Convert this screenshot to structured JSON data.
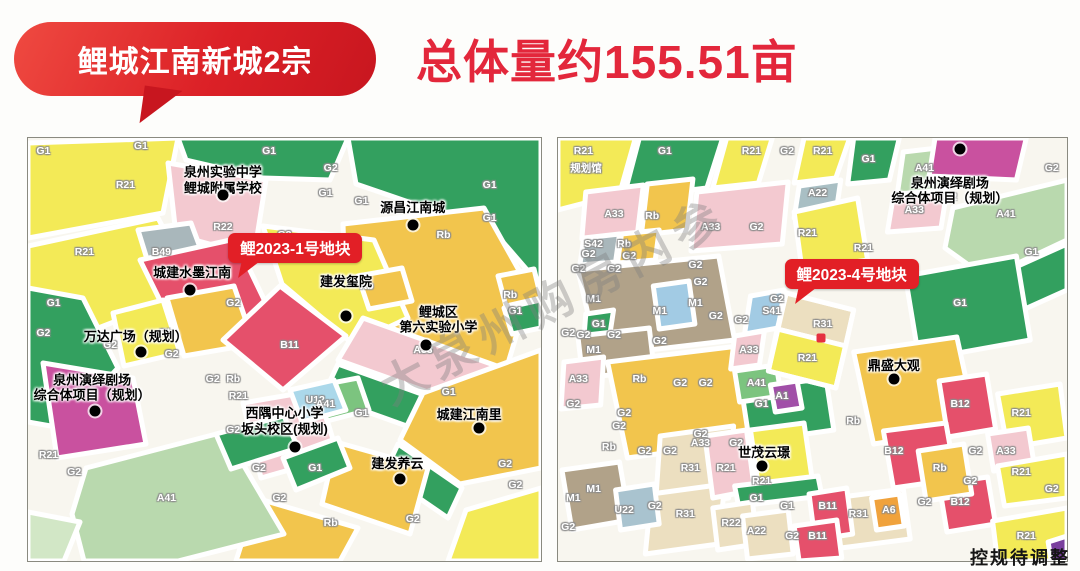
{
  "banner": {
    "label": "鲤城江南新城2宗"
  },
  "title": {
    "text": "总体量约155.51亩"
  },
  "watermark": {
    "text": "大泉州购房内参"
  },
  "footer": {
    "note": "控规待调整"
  },
  "maps": {
    "left": {
      "callout": {
        "text": "鲤2023-1号地块"
      },
      "featured_parcel": "B11",
      "codes": [
        {
          "t": "G1",
          "x": 3,
          "y": 3
        },
        {
          "t": "G1",
          "x": 22,
          "y": 2
        },
        {
          "t": "G1",
          "x": 47,
          "y": 3
        },
        {
          "t": "G2",
          "x": 59,
          "y": 7
        },
        {
          "t": "G1",
          "x": 58,
          "y": 13
        },
        {
          "t": "G1",
          "x": 65,
          "y": 15
        },
        {
          "t": "G1",
          "x": 90,
          "y": 11
        },
        {
          "t": "G1",
          "x": 90,
          "y": 19
        },
        {
          "t": "Rb",
          "x": 81,
          "y": 23
        },
        {
          "t": "R21",
          "x": 19,
          "y": 11
        },
        {
          "t": "R21",
          "x": 11,
          "y": 27
        },
        {
          "t": "B49",
          "x": 26,
          "y": 27
        },
        {
          "t": "R22",
          "x": 38,
          "y": 21
        },
        {
          "t": "G2",
          "x": 50,
          "y": 23
        },
        {
          "t": "G1",
          "x": 5,
          "y": 39
        },
        {
          "t": "G2",
          "x": 3,
          "y": 46
        },
        {
          "t": "G2",
          "x": 16,
          "y": 49
        },
        {
          "t": "Rb",
          "x": 27,
          "y": 46
        },
        {
          "t": "G2",
          "x": 28,
          "y": 51
        },
        {
          "t": "G2",
          "x": 36,
          "y": 57
        },
        {
          "t": "Rb",
          "x": 40,
          "y": 57
        },
        {
          "t": "B11",
          "x": 51,
          "y": 49
        },
        {
          "t": "U12",
          "x": 56,
          "y": 62
        },
        {
          "t": "Rb",
          "x": 66,
          "y": 35
        },
        {
          "t": "G2",
          "x": 40,
          "y": 39
        },
        {
          "t": "A33",
          "x": 77,
          "y": 50
        },
        {
          "t": "Rb",
          "x": 94,
          "y": 37
        },
        {
          "t": "G1",
          "x": 95,
          "y": 41
        },
        {
          "t": "G1",
          "x": 82,
          "y": 60
        },
        {
          "t": "R21",
          "x": 41,
          "y": 61
        },
        {
          "t": "A41",
          "x": 58,
          "y": 63
        },
        {
          "t": "G2",
          "x": 40,
          "y": 69
        },
        {
          "t": "G1",
          "x": 56,
          "y": 78
        },
        {
          "t": "G2",
          "x": 45,
          "y": 78
        },
        {
          "t": "G2",
          "x": 49,
          "y": 85
        },
        {
          "t": "Rb",
          "x": 59,
          "y": 91
        },
        {
          "t": "G1",
          "x": 65,
          "y": 65
        },
        {
          "t": "G2",
          "x": 75,
          "y": 90
        },
        {
          "t": "G2",
          "x": 93,
          "y": 77
        },
        {
          "t": "G2",
          "x": 95,
          "y": 82
        },
        {
          "t": "A41",
          "x": 27,
          "y": 85
        },
        {
          "t": "R21",
          "x": 4,
          "y": 75
        },
        {
          "t": "G2",
          "x": 9,
          "y": 79
        }
      ],
      "pois": [
        {
          "t": "泉州实验中学\n鲤城附属学校",
          "x": 38,
          "y": 10,
          "dot": [
            38,
            13.5
          ]
        },
        {
          "t": "源昌江南城",
          "x": 75,
          "y": 16.5,
          "dot": [
            75,
            20.5
          ]
        },
        {
          "t": "城建水墨江南",
          "x": 32,
          "y": 32,
          "dot": [
            31.5,
            36
          ]
        },
        {
          "t": "建发玺院",
          "x": 62,
          "y": 34,
          "dot": [
            62,
            42
          ]
        },
        {
          "t": "鲤城区\n第六实验小学",
          "x": 80,
          "y": 43,
          "dot": [
            77.5,
            49
          ]
        },
        {
          "t": "万达广场（规划）",
          "x": 21,
          "y": 47,
          "dot": [
            22,
            50.5
          ]
        },
        {
          "t": "泉州演绎剧场\n综合体项目（规划）",
          "x": 12.5,
          "y": 59,
          "dot": [
            13,
            64.5
          ]
        },
        {
          "t": "西隅中心小学\n坂头校区(规划)",
          "x": 50,
          "y": 67,
          "dot": [
            52,
            73
          ]
        },
        {
          "t": "城建江南里",
          "x": 86,
          "y": 65.5,
          "dot": [
            88,
            68.5
          ]
        },
        {
          "t": "建发养云",
          "x": 72,
          "y": 77,
          "dot": [
            72.5,
            80.5
          ]
        }
      ]
    },
    "right": {
      "callout": {
        "text": "鲤2023-4号地块"
      },
      "featured_parcel": "R31 / R21",
      "codes": [
        {
          "t": "R21",
          "x": 5,
          "y": 3
        },
        {
          "t": "规划馆",
          "x": 5.5,
          "y": 7
        },
        {
          "t": "G1",
          "x": 21,
          "y": 3
        },
        {
          "t": "R21",
          "x": 38,
          "y": 3
        },
        {
          "t": "G2",
          "x": 45,
          "y": 3
        },
        {
          "t": "R21",
          "x": 52,
          "y": 3
        },
        {
          "t": "G1",
          "x": 61,
          "y": 5
        },
        {
          "t": "A41",
          "x": 72,
          "y": 7
        },
        {
          "t": "A33",
          "x": 70,
          "y": 17
        },
        {
          "t": "A22",
          "x": 51,
          "y": 13
        },
        {
          "t": "G2",
          "x": 97,
          "y": 7
        },
        {
          "t": "G2",
          "x": 77,
          "y": 14
        },
        {
          "t": "A41",
          "x": 88,
          "y": 18
        },
        {
          "t": "G1",
          "x": 93,
          "y": 27
        },
        {
          "t": "A33",
          "x": 11,
          "y": 18
        },
        {
          "t": "Rb",
          "x": 18.5,
          "y": 18.5
        },
        {
          "t": "A33",
          "x": 30,
          "y": 21
        },
        {
          "t": "G2",
          "x": 39,
          "y": 21
        },
        {
          "t": "R21",
          "x": 49,
          "y": 22.5
        },
        {
          "t": "R21",
          "x": 60,
          "y": 26
        },
        {
          "t": "S42",
          "x": 7,
          "y": 25
        },
        {
          "t": "Rb",
          "x": 13,
          "y": 25
        },
        {
          "t": "G2",
          "x": 6,
          "y": 27.5
        },
        {
          "t": "G2",
          "x": 14,
          "y": 28
        },
        {
          "t": "G2",
          "x": 4,
          "y": 31
        },
        {
          "t": "G2",
          "x": 11,
          "y": 31
        },
        {
          "t": "G2",
          "x": 27,
          "y": 30
        },
        {
          "t": "G2",
          "x": 28,
          "y": 34
        },
        {
          "t": "M1",
          "x": 7,
          "y": 38
        },
        {
          "t": "M1",
          "x": 20,
          "y": 41
        },
        {
          "t": "M1",
          "x": 27,
          "y": 39
        },
        {
          "t": "M1",
          "x": 7,
          "y": 50
        },
        {
          "t": "G1",
          "x": 8,
          "y": 44
        },
        {
          "t": "G2",
          "x": 2,
          "y": 46
        },
        {
          "t": "G2",
          "x": 5,
          "y": 46.5
        },
        {
          "t": "G2",
          "x": 11,
          "y": 46.5
        },
        {
          "t": "G2",
          "x": 20,
          "y": 48
        },
        {
          "t": "G2",
          "x": 31,
          "y": 42
        },
        {
          "t": "G2",
          "x": 36,
          "y": 43
        },
        {
          "t": "A33",
          "x": 4,
          "y": 57
        },
        {
          "t": "Rb",
          "x": 16,
          "y": 57
        },
        {
          "t": "G2",
          "x": 24,
          "y": 58
        },
        {
          "t": "G2",
          "x": 29,
          "y": 58
        },
        {
          "t": "S41",
          "x": 42,
          "y": 41
        },
        {
          "t": "G2",
          "x": 43,
          "y": 38
        },
        {
          "t": "A33",
          "x": 37.5,
          "y": 50
        },
        {
          "t": "A41",
          "x": 39,
          "y": 58
        },
        {
          "t": "A1",
          "x": 44,
          "y": 61
        },
        {
          "t": "R31",
          "x": 52,
          "y": 44
        },
        {
          "t": "R21",
          "x": 49,
          "y": 52
        },
        {
          "t": "G1",
          "x": 79,
          "y": 39
        },
        {
          "t": "G1",
          "x": 40,
          "y": 63
        },
        {
          "t": "Rb",
          "x": 58,
          "y": 67
        },
        {
          "t": "Rb",
          "x": 10,
          "y": 73
        },
        {
          "t": "B12",
          "x": 79,
          "y": 63
        },
        {
          "t": "B12",
          "x": 66,
          "y": 74
        },
        {
          "t": "B12",
          "x": 79,
          "y": 86
        },
        {
          "t": "Rb",
          "x": 75,
          "y": 78
        },
        {
          "t": "G2",
          "x": 82,
          "y": 74
        },
        {
          "t": "G2",
          "x": 81,
          "y": 81
        },
        {
          "t": "G2",
          "x": 72,
          "y": 86
        },
        {
          "t": "G2",
          "x": 97,
          "y": 83
        },
        {
          "t": "R21",
          "x": 91,
          "y": 65
        },
        {
          "t": "A33",
          "x": 88,
          "y": 74
        },
        {
          "t": "R21",
          "x": 91,
          "y": 79
        },
        {
          "t": "R21",
          "x": 92,
          "y": 94
        },
        {
          "t": "B11",
          "x": 53,
          "y": 87
        },
        {
          "t": "R31",
          "x": 59,
          "y": 89
        },
        {
          "t": "A6",
          "x": 65,
          "y": 88
        },
        {
          "t": "B11",
          "x": 51,
          "y": 94
        },
        {
          "t": "R31",
          "x": 26,
          "y": 78
        },
        {
          "t": "R31",
          "x": 25,
          "y": 89
        },
        {
          "t": "R21",
          "x": 33,
          "y": 78
        },
        {
          "t": "R21",
          "x": 40,
          "y": 81
        },
        {
          "t": "U22",
          "x": 13,
          "y": 88
        },
        {
          "t": "G2",
          "x": 19,
          "y": 87
        },
        {
          "t": "G2",
          "x": 2,
          "y": 92
        },
        {
          "t": "G2",
          "x": 3,
          "y": 63
        },
        {
          "t": "G2",
          "x": 13,
          "y": 65
        },
        {
          "t": "G2",
          "x": 12,
          "y": 68
        },
        {
          "t": "G2",
          "x": 17,
          "y": 74
        },
        {
          "t": "G2",
          "x": 22,
          "y": 74
        },
        {
          "t": "A33",
          "x": 28,
          "y": 72
        },
        {
          "t": "G2",
          "x": 35,
          "y": 72
        },
        {
          "t": "G2",
          "x": 28,
          "y": 70
        },
        {
          "t": "R22",
          "x": 34,
          "y": 91
        },
        {
          "t": "A22",
          "x": 39,
          "y": 93
        },
        {
          "t": "G2",
          "x": 46,
          "y": 94
        },
        {
          "t": "G1",
          "x": 39,
          "y": 85
        },
        {
          "t": "G1",
          "x": 45,
          "y": 87
        },
        {
          "t": "M1",
          "x": 3,
          "y": 85
        },
        {
          "t": "M1",
          "x": 7,
          "y": 83
        }
      ],
      "pois": [
        {
          "t": "泉州演绎剧场\n综合体项目（规划）",
          "x": 77,
          "y": 12.5,
          "dot": [
            79,
            2.5
          ]
        },
        {
          "t": "鼎盛大观",
          "x": 66,
          "y": 54,
          "dot": [
            66,
            57
          ]
        },
        {
          "t": "世茂云璟",
          "x": 40.5,
          "y": 74.5,
          "dot": [
            40,
            77.5
          ]
        }
      ]
    }
  }
}
